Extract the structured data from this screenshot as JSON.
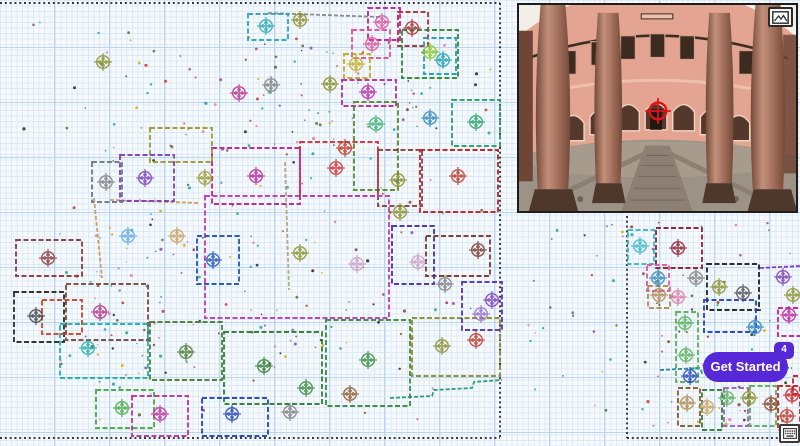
{
  "window": {
    "width": 800,
    "height": 446,
    "description": "SLAM mapping workspace with two occupancy-grid maps, fisheye camera feed and onboarding launcher"
  },
  "theme": {
    "background": "#f7fafd",
    "grid_fine": "#dde9f7",
    "grid_major": "#b9d5f0",
    "boundary_color": "#202020"
  },
  "get_started": {
    "label": "Get Started",
    "badge_count": "4",
    "background": "#5628d8",
    "text_color": "#ffffff"
  },
  "keyboard_button": {
    "icon": "keyboard-icon"
  },
  "camera_panel": {
    "description": "fisheye courtyard camera feed with target crosshair",
    "border": "#1c1c1c",
    "crosshair_color": "#e01414",
    "image_button_icon": "image-icon",
    "colors": {
      "sky": "#f3efe8",
      "building": "#e3a591",
      "building_light": "#eec0ac",
      "roofline": "#3a2d24",
      "window_dark": "#3d2b20",
      "window_frame": "#d9a090",
      "arch_dark": "#54382c",
      "arch_trim": "#f0d6c6",
      "column": "#9c6a56",
      "column_dark": "#744a3a",
      "column_light": "#c2907a",
      "ground": "#9d9286",
      "ground_light": "#ac9f90",
      "path": "#8b8073",
      "path_dark": "#6e6458",
      "side_wall": "#6e4536"
    }
  },
  "dot_palette": [
    "#c0392b",
    "#2e86c1",
    "#27ae60",
    "#8e44ad",
    "#d4ac0d",
    "#e07aa8",
    "#17a2b8",
    "#5a6a2a",
    "#884422",
    "#222222"
  ],
  "main_map": {
    "name": "primary occupancy map",
    "seed": 42,
    "boundary": [
      [
        [
          0,
          3
        ],
        [
          500,
          3
        ]
      ],
      [
        [
          500,
          3
        ],
        [
          500,
          438
        ]
      ],
      [
        [
          0,
          438
        ],
        [
          500,
          438
        ]
      ]
    ],
    "rooms": [
      [
        248,
        14,
        40,
        26,
        "#2aa7b8"
      ],
      [
        368,
        8,
        32,
        32,
        "#c0209a"
      ],
      [
        398,
        12,
        30,
        34,
        "#a83232"
      ],
      [
        402,
        30,
        56,
        48,
        "#2e8b2e"
      ],
      [
        424,
        38,
        32,
        36,
        "#1f9fae"
      ],
      [
        352,
        30,
        38,
        28,
        "#e0509a"
      ],
      [
        344,
        54,
        26,
        24,
        "#c2ab1c"
      ],
      [
        342,
        80,
        54,
        26,
        "#b828a8"
      ],
      [
        354,
        102,
        44,
        88,
        "#5a8a2a"
      ],
      [
        452,
        100,
        48,
        46,
        "#27a06a"
      ],
      [
        420,
        150,
        78,
        62,
        "#bb2222"
      ],
      [
        378,
        150,
        44,
        56,
        "#8a4040"
      ],
      [
        300,
        142,
        78,
        54,
        "#cc3333"
      ],
      [
        212,
        148,
        88,
        56,
        "#bb2299"
      ],
      [
        150,
        128,
        62,
        34,
        "#9a9a30"
      ],
      [
        120,
        155,
        54,
        46,
        "#7a3fc0"
      ],
      [
        92,
        162,
        30,
        40,
        "#6a7a8a"
      ],
      [
        16,
        240,
        66,
        36,
        "#8a3a3a"
      ],
      [
        14,
        292,
        50,
        50,
        "#2a2a2a"
      ],
      [
        66,
        284,
        82,
        56,
        "#7a4a3a"
      ],
      [
        205,
        196,
        184,
        122,
        "#c23ab0"
      ],
      [
        42,
        300,
        40,
        34,
        "#cc4422"
      ],
      [
        60,
        324,
        88,
        54,
        "#20b2aa"
      ],
      [
        150,
        322,
        72,
        58,
        "#4a7d32"
      ],
      [
        224,
        332,
        98,
        72,
        "#2e7d32"
      ],
      [
        326,
        320,
        84,
        86,
        "#3a8a3a"
      ],
      [
        412,
        318,
        88,
        58,
        "#8a8f2a"
      ],
      [
        426,
        236,
        64,
        40,
        "#7a3a28"
      ],
      [
        392,
        226,
        42,
        58,
        "#4430aa"
      ],
      [
        96,
        390,
        58,
        38,
        "#44aa44"
      ],
      [
        132,
        396,
        56,
        40,
        "#c030a0"
      ],
      [
        202,
        398,
        66,
        38,
        "#2244bb"
      ],
      [
        197,
        236,
        42,
        48,
        "#2255bb"
      ],
      [
        462,
        282,
        40,
        48,
        "#5533bb"
      ]
    ],
    "walls": [
      [
        [
          [
            268,
            13
          ],
          [
            380,
            17
          ]
        ],
        "#8a8a8a"
      ],
      [
        [
          [
            390,
            398
          ],
          [
            432,
            396
          ],
          [
            434,
            390
          ],
          [
            472,
            388
          ],
          [
            474,
            382
          ],
          [
            502,
            380
          ]
        ],
        "#2e9e7a"
      ],
      [
        [
          [
            94,
            198
          ],
          [
            102,
            278
          ]
        ],
        "#c8a060"
      ],
      [
        [
          [
            110,
            200
          ],
          [
            200,
            203
          ]
        ],
        "#c8a060"
      ],
      [
        [
          [
            285,
            162
          ],
          [
            289,
            290
          ]
        ],
        "#b5aa80"
      ]
    ],
    "markers": [
      [
        266,
        26,
        "#2aa7b8"
      ],
      [
        382,
        22,
        "#e0509a"
      ],
      [
        412,
        28,
        "#a83232"
      ],
      [
        430,
        52,
        "#82c91e"
      ],
      [
        443,
        60,
        "#1f9fae"
      ],
      [
        372,
        44,
        "#e0509a"
      ],
      [
        356,
        64,
        "#c2ab1c"
      ],
      [
        368,
        92,
        "#b828a8"
      ],
      [
        376,
        124,
        "#3cb371"
      ],
      [
        430,
        118,
        "#2e86c1"
      ],
      [
        476,
        122,
        "#27a06a"
      ],
      [
        300,
        20,
        "#8a8f2a"
      ],
      [
        330,
        84,
        "#8a8f2a"
      ],
      [
        239,
        93,
        "#b5338a"
      ],
      [
        271,
        85,
        "#808080"
      ],
      [
        103,
        62,
        "#8a8f2a"
      ],
      [
        336,
        168,
        "#cc3333"
      ],
      [
        398,
        180,
        "#8a8f2a"
      ],
      [
        458,
        176,
        "#c0392b"
      ],
      [
        345,
        148,
        "#c0392b"
      ],
      [
        256,
        176,
        "#bb2299"
      ],
      [
        205,
        178,
        "#9a9a30"
      ],
      [
        145,
        178,
        "#7a3fc0"
      ],
      [
        106,
        182,
        "#808080"
      ],
      [
        400,
        212,
        "#8a8f2a"
      ],
      [
        478,
        250,
        "#7a3a28"
      ],
      [
        418,
        262,
        "#c8a2c8"
      ],
      [
        445,
        284,
        "#808080"
      ],
      [
        492,
        300,
        "#7d3fc0"
      ],
      [
        481,
        314,
        "#9a70d0"
      ],
      [
        128,
        236,
        "#5dade2"
      ],
      [
        177,
        236,
        "#c8a060"
      ],
      [
        213,
        260,
        "#2255bb"
      ],
      [
        300,
        253,
        "#8a8f2a"
      ],
      [
        357,
        264,
        "#c8a2c8"
      ],
      [
        48,
        258,
        "#8a3a3a"
      ],
      [
        36,
        316,
        "#444444"
      ],
      [
        100,
        312,
        "#b5338a"
      ],
      [
        88,
        348,
        "#20b2aa"
      ],
      [
        186,
        352,
        "#4a7d32"
      ],
      [
        264,
        366,
        "#2e7d32"
      ],
      [
        306,
        388,
        "#3a8a3a"
      ],
      [
        368,
        360,
        "#3a8a3a"
      ],
      [
        442,
        346,
        "#8a8f2a"
      ],
      [
        476,
        340,
        "#c0392b"
      ],
      [
        122,
        408,
        "#44aa44"
      ],
      [
        160,
        414,
        "#c030a0"
      ],
      [
        232,
        414,
        "#2244bb"
      ],
      [
        290,
        412,
        "#808080"
      ],
      [
        350,
        394,
        "#8a5a2b"
      ]
    ],
    "dot_regions": [
      {
        "n": 140,
        "x": 95,
        "y": 35,
        "w": 320,
        "h": 340
      },
      {
        "n": 45,
        "x": 55,
        "y": 200,
        "w": 110,
        "h": 220
      },
      {
        "n": 45,
        "x": 245,
        "y": 35,
        "w": 250,
        "h": 115
      },
      {
        "n": 55,
        "x": 2,
        "y": 8,
        "w": 495,
        "h": 420
      }
    ]
  },
  "mini_map": {
    "name": "secondary occupancy map",
    "seed": 7,
    "boundary": [
      [
        [
          627,
          216
        ],
        [
          627,
          438
        ]
      ],
      [
        [
          627,
          438
        ],
        [
          800,
          438
        ]
      ]
    ],
    "rooms": [
      [
        628,
        230,
        26,
        34,
        "#3ab8c8"
      ],
      [
        656,
        228,
        46,
        40,
        "#8a2030"
      ],
      [
        647,
        265,
        22,
        26,
        "#e055a0"
      ],
      [
        648,
        286,
        22,
        22,
        "#b08a50"
      ],
      [
        707,
        264,
        52,
        46,
        "#222222"
      ],
      [
        778,
        308,
        24,
        28,
        "#c020a0"
      ],
      [
        676,
        312,
        22,
        70,
        "#58b058"
      ],
      [
        704,
        300,
        52,
        32,
        "#2244bb"
      ],
      [
        678,
        388,
        22,
        38,
        "#8a5a2b"
      ],
      [
        702,
        390,
        20,
        40,
        "#2e7d32"
      ],
      [
        724,
        388,
        24,
        38,
        "#9a60c8"
      ],
      [
        750,
        386,
        26,
        40,
        "#58b058"
      ],
      [
        778,
        386,
        22,
        44,
        "#cc2222"
      ],
      [
        793,
        376,
        12,
        18,
        "#cc2222"
      ]
    ],
    "walls": [
      [
        [
          [
            760,
            268
          ],
          [
            800,
            266
          ]
        ],
        "#7d3fc0"
      ],
      [
        [
          [
            660,
            370
          ],
          [
            700,
            368
          ],
          [
            702,
            373
          ],
          [
            760,
            371
          ],
          [
            762,
            366
          ],
          [
            792,
            368
          ]
        ],
        "#2088a0"
      ]
    ],
    "markers": [
      [
        640,
        246,
        "#3ab8c8"
      ],
      [
        678,
        248,
        "#8a2030"
      ],
      [
        696,
        278,
        "#808080"
      ],
      [
        719,
        287,
        "#8a8f2a"
      ],
      [
        743,
        293,
        "#555555"
      ],
      [
        783,
        277,
        "#7d3fc0"
      ],
      [
        789,
        315,
        "#c020a0"
      ],
      [
        793,
        295,
        "#8a8f2a"
      ],
      [
        658,
        278,
        "#2e86c1"
      ],
      [
        659,
        295,
        "#b08a50"
      ],
      [
        678,
        297,
        "#e07aa8"
      ],
      [
        685,
        323,
        "#58b058"
      ],
      [
        686,
        355,
        "#58b058"
      ],
      [
        690,
        376,
        "#2244bb"
      ],
      [
        755,
        327,
        "#2e86c1"
      ],
      [
        687,
        403,
        "#b08a50"
      ],
      [
        707,
        407,
        "#c8a060"
      ],
      [
        727,
        398,
        "#58b058"
      ],
      [
        749,
        398,
        "#8a8f2a"
      ],
      [
        771,
        404,
        "#884422"
      ],
      [
        787,
        416,
        "#c0392b"
      ],
      [
        792,
        395,
        "#cc2222"
      ]
    ],
    "dot_regions": [
      {
        "n": 65,
        "x": 630,
        "y": 222,
        "w": 168,
        "h": 205
      },
      {
        "n": 26,
        "x": 517,
        "y": 218,
        "w": 108,
        "h": 222
      }
    ]
  }
}
